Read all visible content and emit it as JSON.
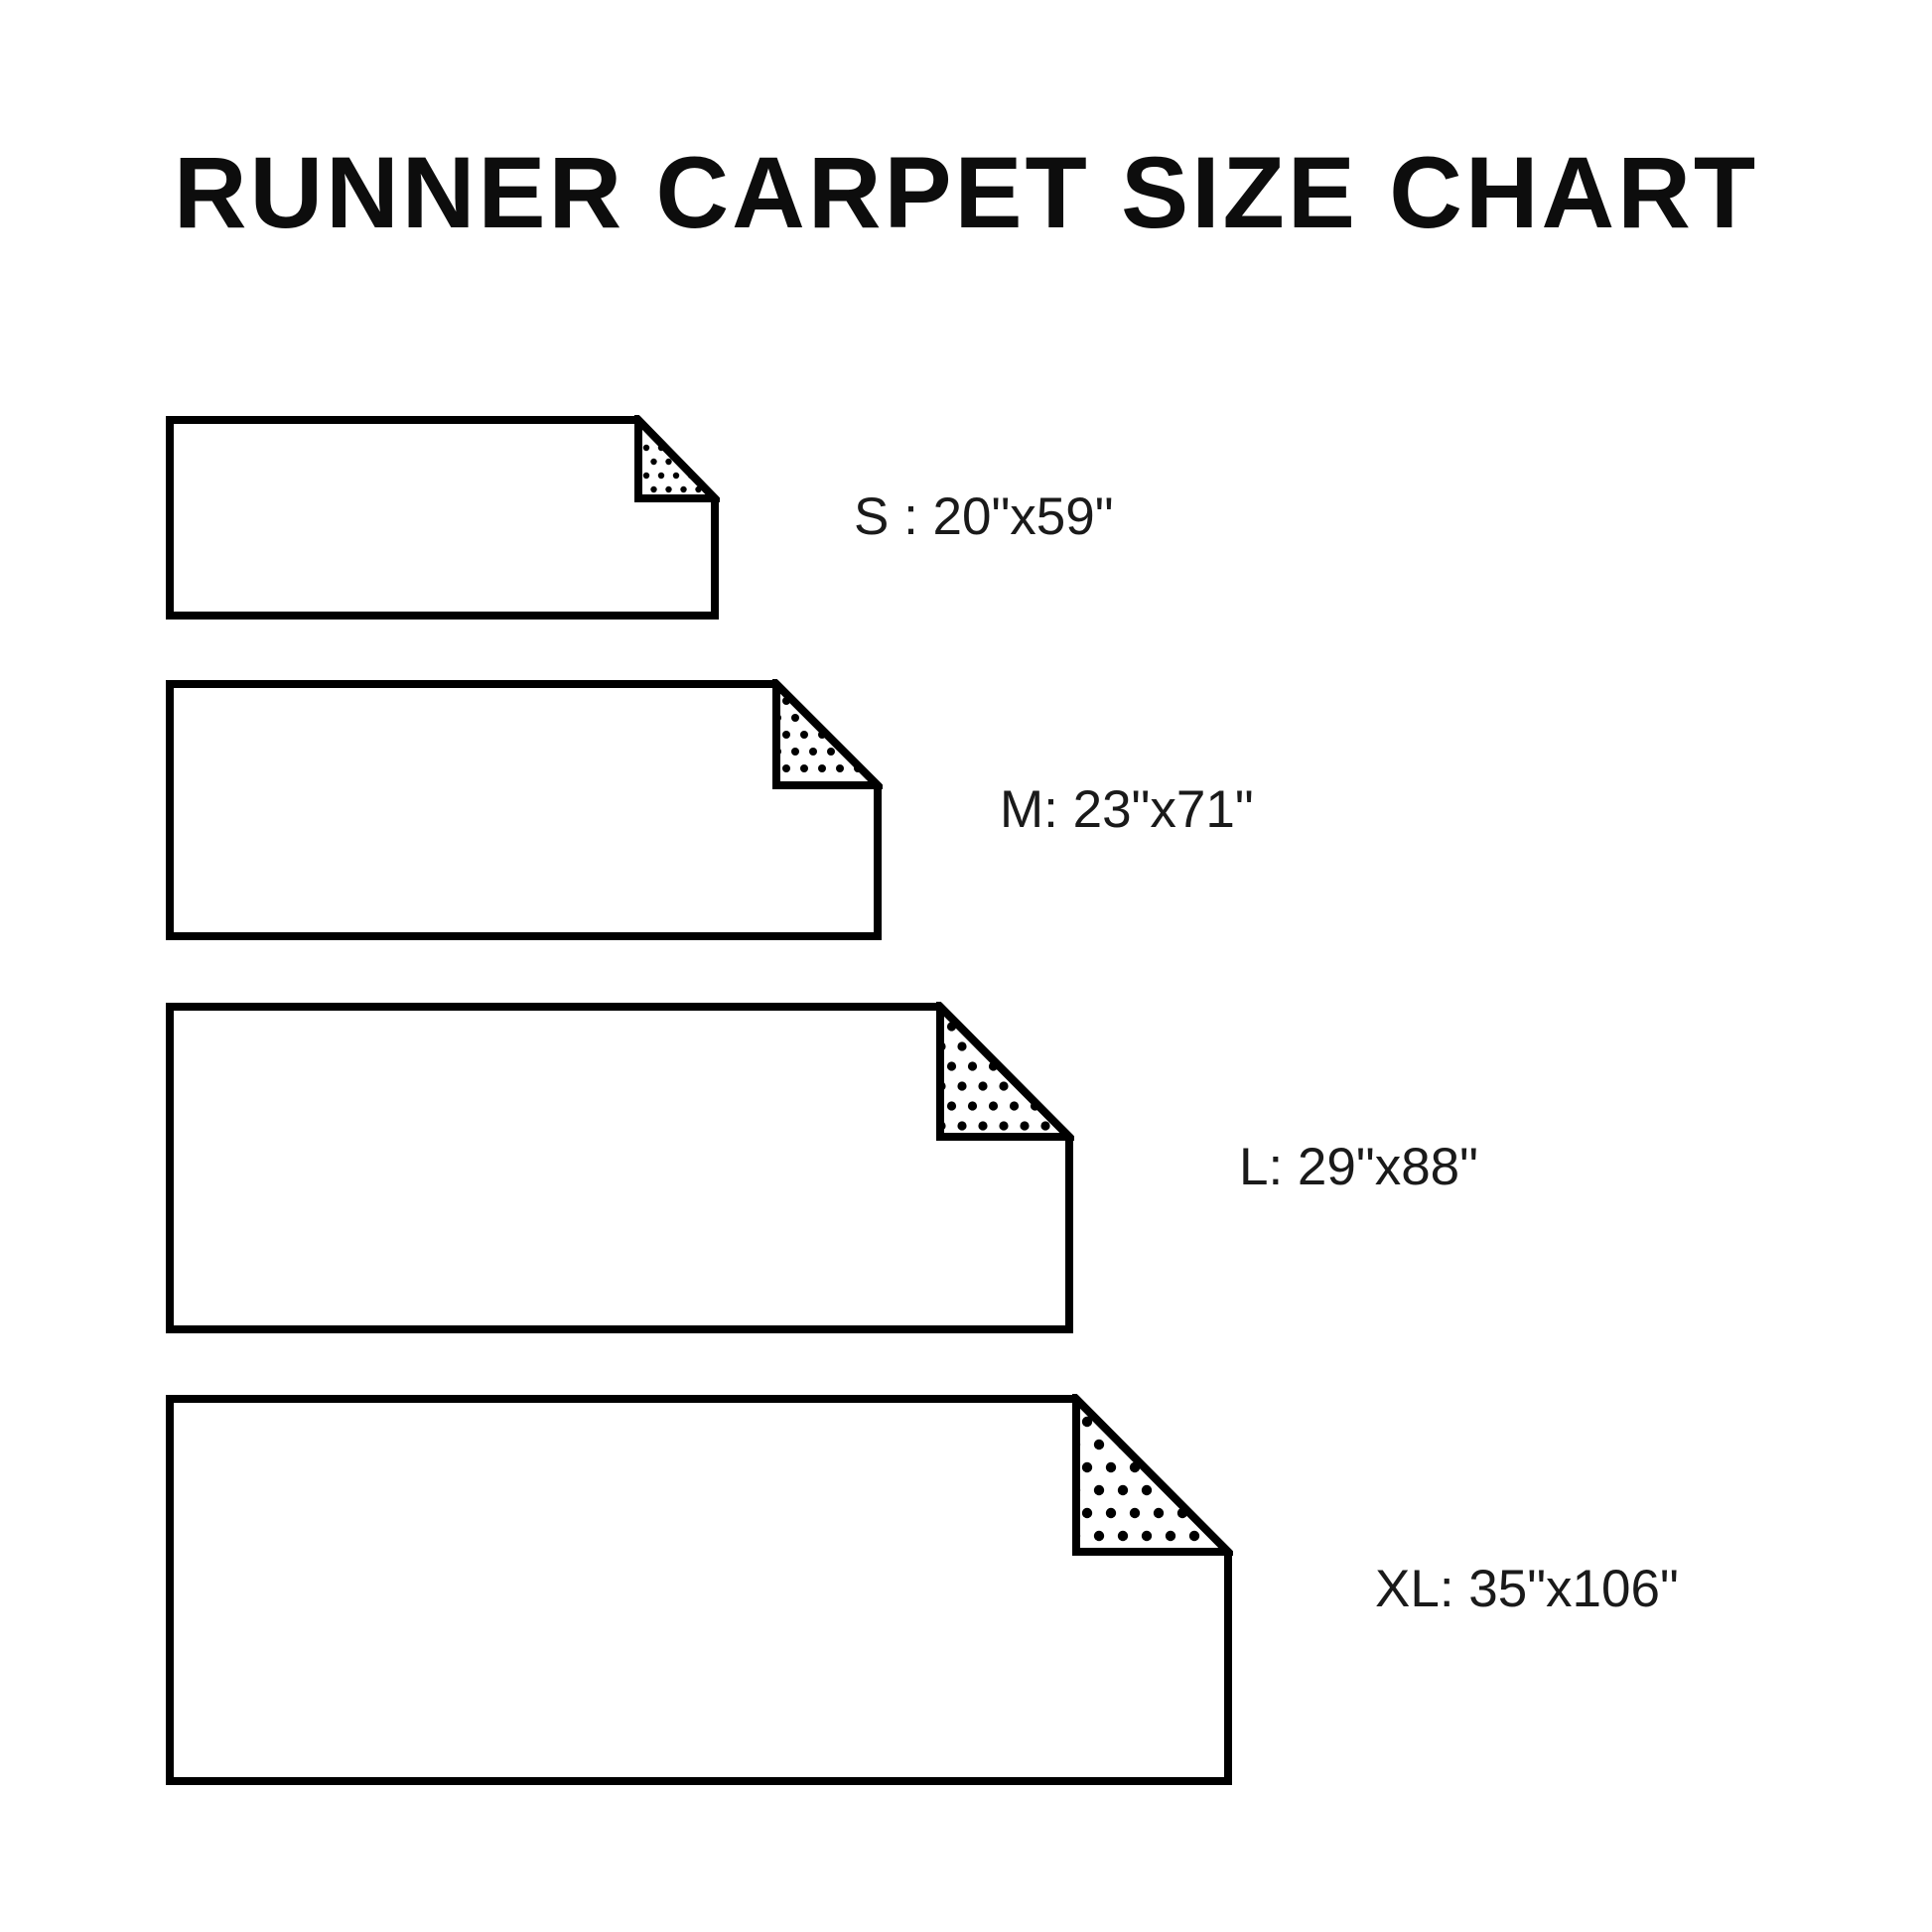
{
  "title": "RUNNER CARPET SIZE CHART",
  "colors": {
    "background": "#ffffff",
    "outline": "#000000",
    "title_text": "#0d0d0d",
    "label_text": "#1a1a1a"
  },
  "carpets": [
    {
      "size_code": "S",
      "label": "S : 20\"x59\"",
      "width_in": "20\"",
      "length_in": "59\""
    },
    {
      "size_code": "M",
      "label": "M: 23\"x71\"",
      "width_in": "23\"",
      "length_in": "71\""
    },
    {
      "size_code": "L",
      "label": "L: 29\"x88\"",
      "width_in": "29\"",
      "length_in": "88\""
    },
    {
      "size_code": "XL",
      "label": "XL: 35\"x106\"",
      "width_in": "35\"",
      "length_in": "106\""
    }
  ]
}
